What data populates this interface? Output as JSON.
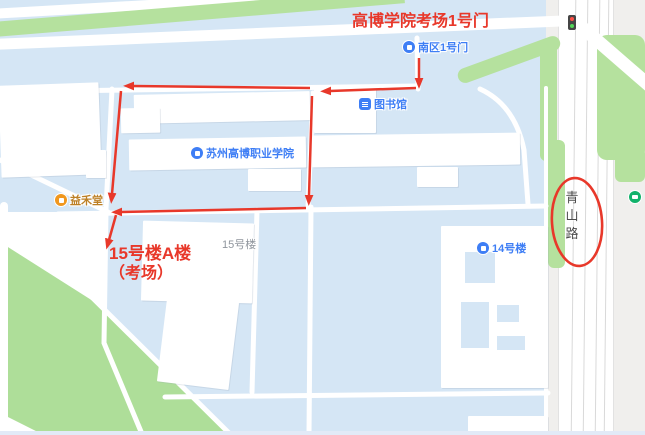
{
  "colors": {
    "annotation_red": "#e8382a",
    "water_blue": "#d5e6f5",
    "poi_blue": "#3e7ef5",
    "green_area": "#aede99",
    "roadside_gray": "#f0efed"
  },
  "annotations": {
    "gate_title": "高博学院考场1号门",
    "destination_line1": "15号楼A楼",
    "destination_line2": "（考场）"
  },
  "pois": {
    "south_gate": {
      "label": "南区1号门"
    },
    "library": {
      "label": "图书馆"
    },
    "college": {
      "label": "苏州高博职业学院"
    },
    "milk_tea": {
      "label": "益禾堂"
    },
    "building_15": {
      "label": "15号楼"
    },
    "building_14": {
      "label": "14号楼"
    }
  },
  "road": {
    "name_chars": [
      "青",
      "山",
      "路"
    ]
  }
}
